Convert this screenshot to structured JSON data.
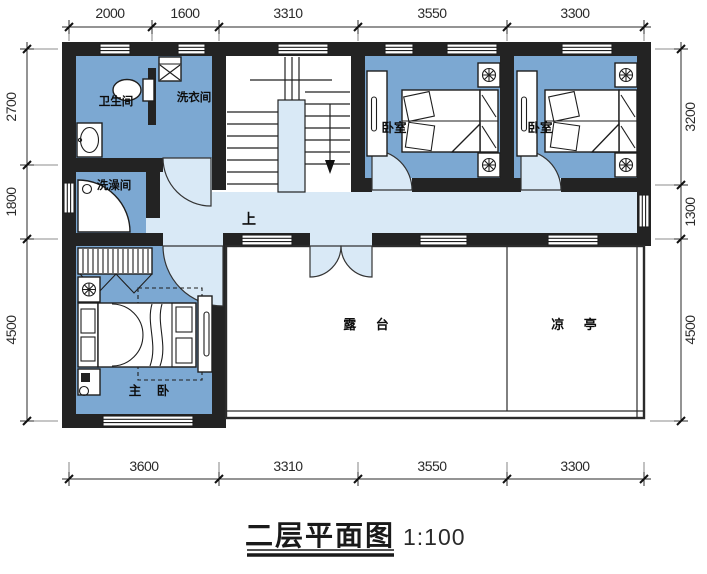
{
  "title": {
    "name": "二层平面图",
    "scale": "1:100"
  },
  "labels": {
    "bathroom": "卫生间",
    "laundry": "洗衣间",
    "shower": "洗澡间",
    "stairs_up": "上",
    "bedroom1": "卧室",
    "bedroom2": "卧室",
    "master_bedroom": "主 卧",
    "terrace": "露 台",
    "pavilion": "凉 亭"
  },
  "dimensions": {
    "top": [
      "2000",
      "1600",
      "3310",
      "3550",
      "3300"
    ],
    "bottom": [
      "3600",
      "3310",
      "3550",
      "3300"
    ],
    "left": [
      "2700",
      "1800",
      "4500"
    ],
    "right": [
      "3200",
      "1300",
      "4500"
    ]
  },
  "colors": {
    "wall": "#232323",
    "room": "#7CA8D2",
    "corridor": "#D9E9F6",
    "line": "#2b2b2b"
  }
}
